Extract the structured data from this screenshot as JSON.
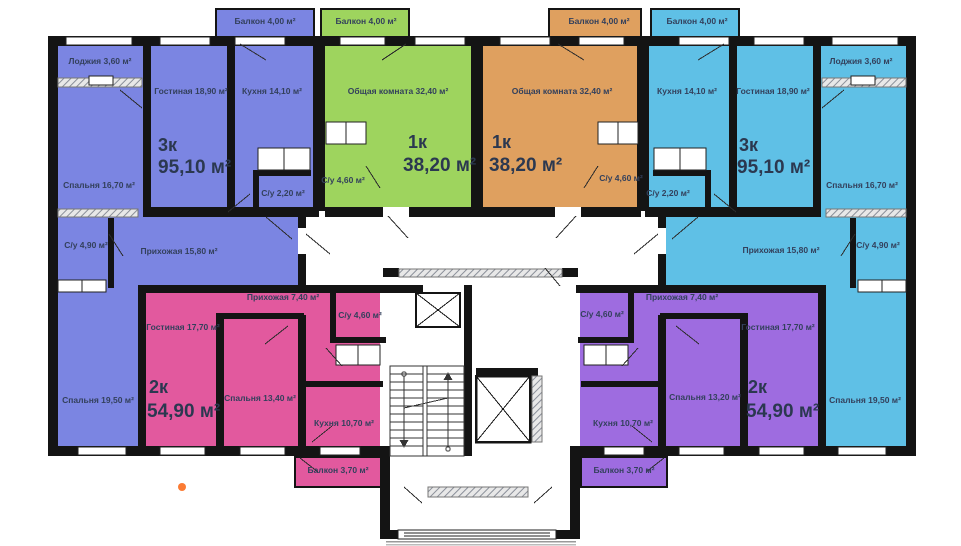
{
  "apartments": [
    {
      "id": "3k-left",
      "type_label": "3к",
      "area_label": "95,10 м²",
      "color": "#7b85e2",
      "rooms": {
        "balcony": "Балкон 4,00 м²",
        "loggia": "Лоджия 3,60 м²",
        "living": "Гостиная 18,90 м²",
        "kitchen": "Кухня 14,10 м²",
        "bedroom1": "Спальня 16,70 м²",
        "wc_small": "С/у 2,20 м²",
        "wc_big": "С/у 4,90 м²",
        "hall": "Прихожая 15,80 м²",
        "bedroom2": "Спальня 19,50 м²"
      }
    },
    {
      "id": "1k-left",
      "type_label": "1к",
      "area_label": "38,20 м²",
      "color": "#9ed45e",
      "rooms": {
        "balcony": "Балкон 4,00 м²",
        "main": "Общая комната 32,40 м²",
        "wc": "С/у 4,60 м²"
      }
    },
    {
      "id": "1k-right",
      "type_label": "1к",
      "area_label": "38,20 м²",
      "color": "#dfa05f",
      "rooms": {
        "balcony": "Балкон 4,00 м²",
        "main": "Общая комната 32,40 м²",
        "wc": "С/у 4,60 м²"
      }
    },
    {
      "id": "3k-right",
      "type_label": "3к",
      "area_label": "95,10 м²",
      "color": "#5fc0e6",
      "rooms": {
        "balcony": "Балкон 4,00 м²",
        "loggia": "Лоджия 3,60 м²",
        "living": "Гостиная 18,90 м²",
        "kitchen": "Кухня 14,10 м²",
        "bedroom1": "Спальня 16,70 м²",
        "wc_small": "С/у 2,20 м²",
        "wc_big": "С/у 4,90 м²",
        "hall": "Прихожая 15,80 м²",
        "bedroom2": "Спальня 19,50 м²"
      }
    },
    {
      "id": "2k-left",
      "type_label": "2к",
      "area_label": "54,90 м²",
      "color": "#e2599e",
      "rooms": {
        "hall": "Прихожая 7,40 м²",
        "wc": "С/у 4,60 м²",
        "living": "Гостиная 17,70 м²",
        "bedroom": "Спальня 13,40 м²",
        "kitchen": "Кухня 10,70 м²",
        "balcony": "Балкон 3,70 м²"
      }
    },
    {
      "id": "2k-right",
      "type_label": "2к",
      "area_label": "54,90 м²",
      "color": "#9e6ce0",
      "rooms": {
        "hall": "Прихожая 7,40 м²",
        "wc": "С/у 4,60 м²",
        "living": "Гостиная 17,70 м²",
        "bedroom": "Спальня 13,20 м²",
        "kitchen": "Кухня 10,70 м²",
        "balcony": "Балкон 3,70 м²"
      }
    }
  ],
  "colors": {
    "walls": "#141414",
    "label_text": "#33405c",
    "accent_dot": "#fb7b33"
  }
}
